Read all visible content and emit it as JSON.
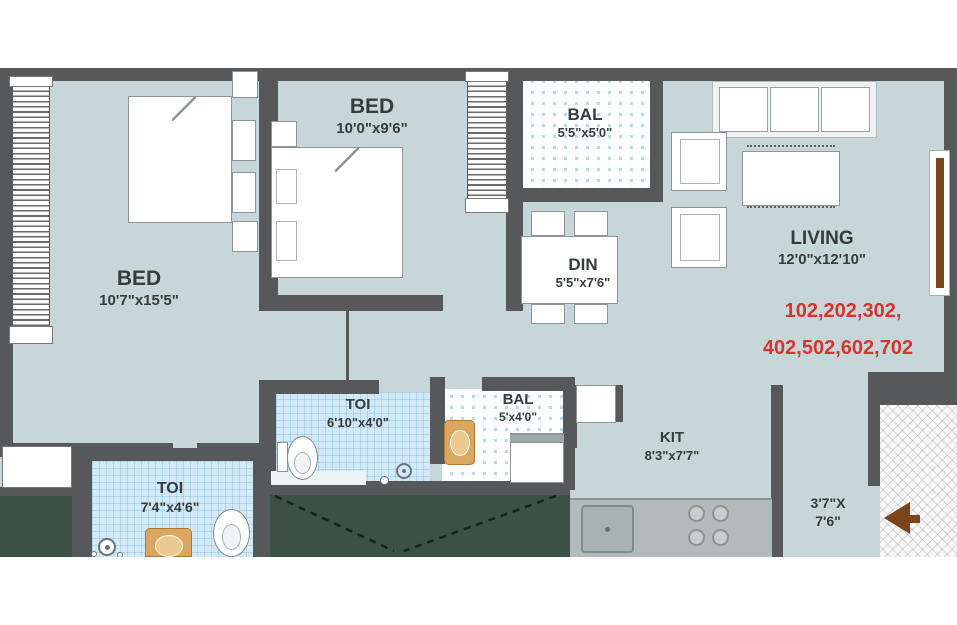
{
  "colors": {
    "floor": "#c7d7d9",
    "wall": "#57585a",
    "toiFloor": "#d2eaf7",
    "balTile": "#bcd9e6",
    "green": "#3c5046",
    "accentRed": "#d5342f",
    "doorBrown": "#7c441a",
    "basinTan": "#d9a75f",
    "counterGray": "#b2bbbb",
    "label": "#353c40"
  },
  "rooms": {
    "bed1": {
      "name": "BED",
      "dims": "10'7\"x15'5\""
    },
    "bed2": {
      "name": "BED",
      "dims": "10'0\"x9'6\""
    },
    "balTop": {
      "name": "BAL",
      "dims": "5'5\"x5'0\""
    },
    "living": {
      "name": "LIVING",
      "dims": "12'0\"x12'10\""
    },
    "din": {
      "name": "DIN",
      "dims": "5'5\"x7'6\""
    },
    "toiMid": {
      "name": "TOI",
      "dims": "6'10\"x4'0\""
    },
    "balMid": {
      "name": "BAL",
      "dims": "5'x4'0\""
    },
    "kit": {
      "name": "KIT",
      "dims": "8'3\"x7'7\""
    },
    "toiBottom": {
      "name": "TOI",
      "dims": "7'4\"x4'6\""
    },
    "passage": {
      "dims_line1": "3'7\"X",
      "dims_line2": "7'6\""
    }
  },
  "units": {
    "line1": "102,202,302,",
    "line2": "402,502,602,702"
  }
}
